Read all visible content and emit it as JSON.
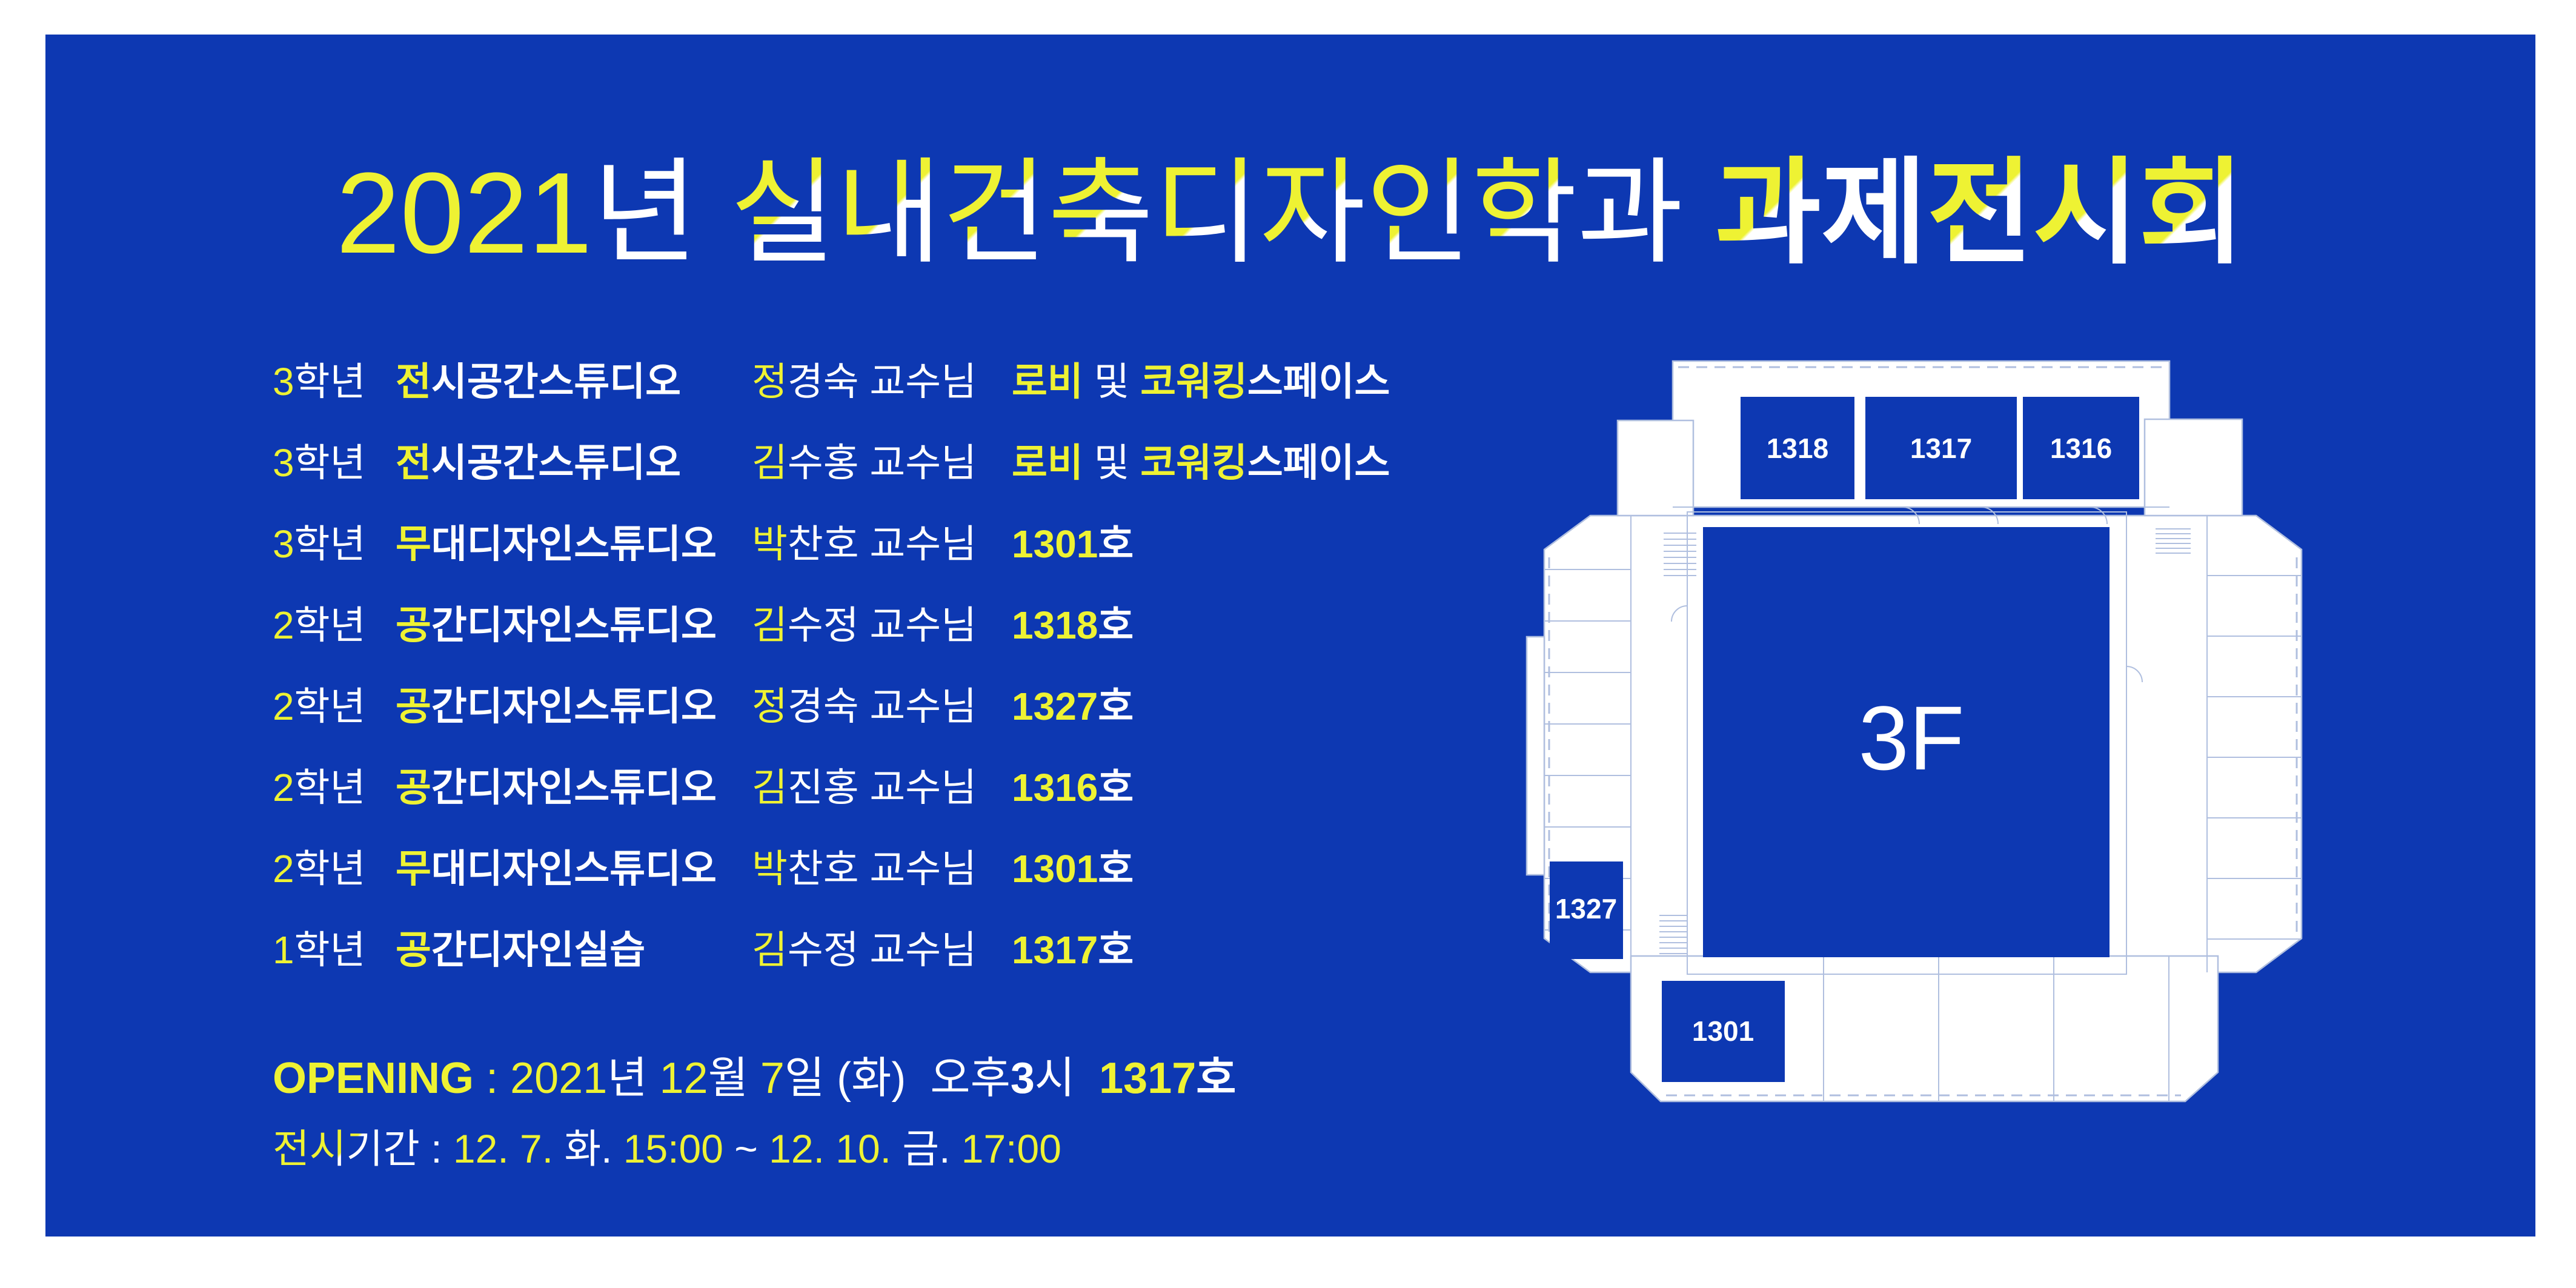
{
  "colors": {
    "margin_background": "#ffffff",
    "panel_background": "#0d38b2",
    "accent_yellow": "#eef233",
    "text_white": "#ffffff",
    "plan_line_blue": "#b0bfdf"
  },
  "title": {
    "segments": [
      {
        "t": "2021",
        "c": "y"
      },
      {
        "t": "년",
        "c": "w"
      },
      {
        "t": " ",
        "c": "w"
      },
      {
        "t": "실",
        "c": "yw"
      },
      {
        "t": "내",
        "c": "yw"
      },
      {
        "t": "건",
        "c": "yw"
      },
      {
        "t": "축",
        "c": "yw"
      },
      {
        "t": "디",
        "c": "yw"
      },
      {
        "t": "자",
        "c": "yw"
      },
      {
        "t": "인",
        "c": "yw"
      },
      {
        "t": "학",
        "c": "yw"
      },
      {
        "t": "과",
        "c": "w"
      },
      {
        "t": " ",
        "c": "w"
      },
      {
        "t": "과",
        "c": "yw",
        "w": "bold"
      },
      {
        "t": "제",
        "c": "w",
        "w": "bold"
      },
      {
        "t": "전",
        "c": "yw",
        "w": "bold"
      },
      {
        "t": "시",
        "c": "yw",
        "w": "bold"
      },
      {
        "t": "회",
        "c": "yw",
        "w": "bold"
      }
    ]
  },
  "schedule": {
    "rows": [
      {
        "grade": [
          {
            "t": "3",
            "c": "y"
          },
          {
            "t": "학년",
            "c": "w"
          }
        ],
        "studio": [
          {
            "t": "전",
            "c": "y"
          },
          {
            "t": "시공간스튜디오",
            "c": "w"
          }
        ],
        "professor": [
          {
            "t": "정",
            "c": "y"
          },
          {
            "t": "경숙 교수님",
            "c": "w"
          }
        ],
        "location": [
          {
            "t": "로비",
            "c": "y"
          },
          {
            "t": " 및 ",
            "c": "w",
            "w": "light"
          },
          {
            "t": "코워킹",
            "c": "y"
          },
          {
            "t": "스페이스",
            "c": "w"
          }
        ]
      },
      {
        "grade": [
          {
            "t": "3",
            "c": "y"
          },
          {
            "t": "학년",
            "c": "w"
          }
        ],
        "studio": [
          {
            "t": "전",
            "c": "y"
          },
          {
            "t": "시공간스튜디오",
            "c": "w"
          }
        ],
        "professor": [
          {
            "t": "김",
            "c": "y"
          },
          {
            "t": "수홍 교수님",
            "c": "w"
          }
        ],
        "location": [
          {
            "t": "로비",
            "c": "y"
          },
          {
            "t": " 및 ",
            "c": "w",
            "w": "light"
          },
          {
            "t": "코워킹",
            "c": "y"
          },
          {
            "t": "스페이스",
            "c": "w"
          }
        ]
      },
      {
        "grade": [
          {
            "t": "3",
            "c": "y"
          },
          {
            "t": "학년",
            "c": "w"
          }
        ],
        "studio": [
          {
            "t": "무",
            "c": "y"
          },
          {
            "t": "대디자인스튜디오",
            "c": "w"
          }
        ],
        "professor": [
          {
            "t": "박",
            "c": "y"
          },
          {
            "t": "찬호 교수님",
            "c": "w"
          }
        ],
        "location": [
          {
            "t": "1301",
            "c": "y"
          },
          {
            "t": "호",
            "c": "w"
          }
        ]
      },
      {
        "grade": [
          {
            "t": "2",
            "c": "y"
          },
          {
            "t": "학년",
            "c": "w"
          }
        ],
        "studio": [
          {
            "t": "공",
            "c": "y"
          },
          {
            "t": "간디자인스튜디오",
            "c": "w"
          }
        ],
        "professor": [
          {
            "t": "김",
            "c": "y"
          },
          {
            "t": "수정 교수님",
            "c": "w"
          }
        ],
        "location": [
          {
            "t": "1318",
            "c": "y"
          },
          {
            "t": "호",
            "c": "w"
          }
        ]
      },
      {
        "grade": [
          {
            "t": "2",
            "c": "y"
          },
          {
            "t": "학년",
            "c": "w"
          }
        ],
        "studio": [
          {
            "t": "공",
            "c": "y"
          },
          {
            "t": "간디자인스튜디오",
            "c": "w"
          }
        ],
        "professor": [
          {
            "t": "정",
            "c": "y"
          },
          {
            "t": "경숙 교수님",
            "c": "w"
          }
        ],
        "location": [
          {
            "t": "1327",
            "c": "y"
          },
          {
            "t": "호",
            "c": "w"
          }
        ]
      },
      {
        "grade": [
          {
            "t": "2",
            "c": "y"
          },
          {
            "t": "학년",
            "c": "w"
          }
        ],
        "studio": [
          {
            "t": "공",
            "c": "y"
          },
          {
            "t": "간디자인스튜디오",
            "c": "w"
          }
        ],
        "professor": [
          {
            "t": "김",
            "c": "y"
          },
          {
            "t": "진홍 교수님",
            "c": "w"
          }
        ],
        "location": [
          {
            "t": "1316",
            "c": "y"
          },
          {
            "t": "호",
            "c": "w"
          }
        ]
      },
      {
        "grade": [
          {
            "t": "2",
            "c": "y"
          },
          {
            "t": "학년",
            "c": "w"
          }
        ],
        "studio": [
          {
            "t": "무",
            "c": "y"
          },
          {
            "t": "대디자인스튜디오",
            "c": "w"
          }
        ],
        "professor": [
          {
            "t": "박",
            "c": "y"
          },
          {
            "t": "찬호 교수님",
            "c": "w"
          }
        ],
        "location": [
          {
            "t": "1301",
            "c": "y"
          },
          {
            "t": "호",
            "c": "w"
          }
        ]
      },
      {
        "grade": [
          {
            "t": "1",
            "c": "y"
          },
          {
            "t": "학년",
            "c": "w"
          }
        ],
        "studio": [
          {
            "t": "공",
            "c": "y"
          },
          {
            "t": "간디자인실습",
            "c": "w"
          }
        ],
        "professor": [
          {
            "t": "김",
            "c": "y"
          },
          {
            "t": "수정 교수님",
            "c": "w"
          }
        ],
        "location": [
          {
            "t": "1317",
            "c": "y"
          },
          {
            "t": "호",
            "c": "w"
          }
        ]
      }
    ]
  },
  "opening": {
    "segments": [
      {
        "t": "OPENING",
        "c": "y",
        "w": "bold"
      },
      {
        "t": " : ",
        "c": "y"
      },
      {
        "t": "2021",
        "c": "y"
      },
      {
        "t": "년 ",
        "c": "w"
      },
      {
        "t": "12",
        "c": "y"
      },
      {
        "t": "월 ",
        "c": "w"
      },
      {
        "t": "7",
        "c": "y"
      },
      {
        "t": "일 (화)",
        "c": "w"
      },
      {
        "t": "  오후",
        "c": "w"
      },
      {
        "t": "3",
        "c": "w",
        "w": "bold"
      },
      {
        "t": "시  ",
        "c": "w"
      },
      {
        "t": "1317",
        "c": "y",
        "w": "bold"
      },
      {
        "t": "호",
        "c": "w",
        "w": "bold"
      }
    ]
  },
  "period": {
    "segments": [
      {
        "t": "전시기간",
        "c": "yw"
      },
      {
        "t": " : ",
        "c": "w"
      },
      {
        "t": "12. 7. ",
        "c": "y"
      },
      {
        "t": "화. ",
        "c": "w"
      },
      {
        "t": "15:00 ",
        "c": "y"
      },
      {
        "t": "~ ",
        "c": "w"
      },
      {
        "t": "12. 10. ",
        "c": "y"
      },
      {
        "t": "금. ",
        "c": "w"
      },
      {
        "t": "17:00",
        "c": "y"
      }
    ]
  },
  "floor_plan": {
    "floor_label": "3F",
    "rooms": [
      {
        "label": "1318"
      },
      {
        "label": "1317"
      },
      {
        "label": "1316"
      },
      {
        "label": "1327"
      },
      {
        "label": "1301"
      }
    ]
  }
}
